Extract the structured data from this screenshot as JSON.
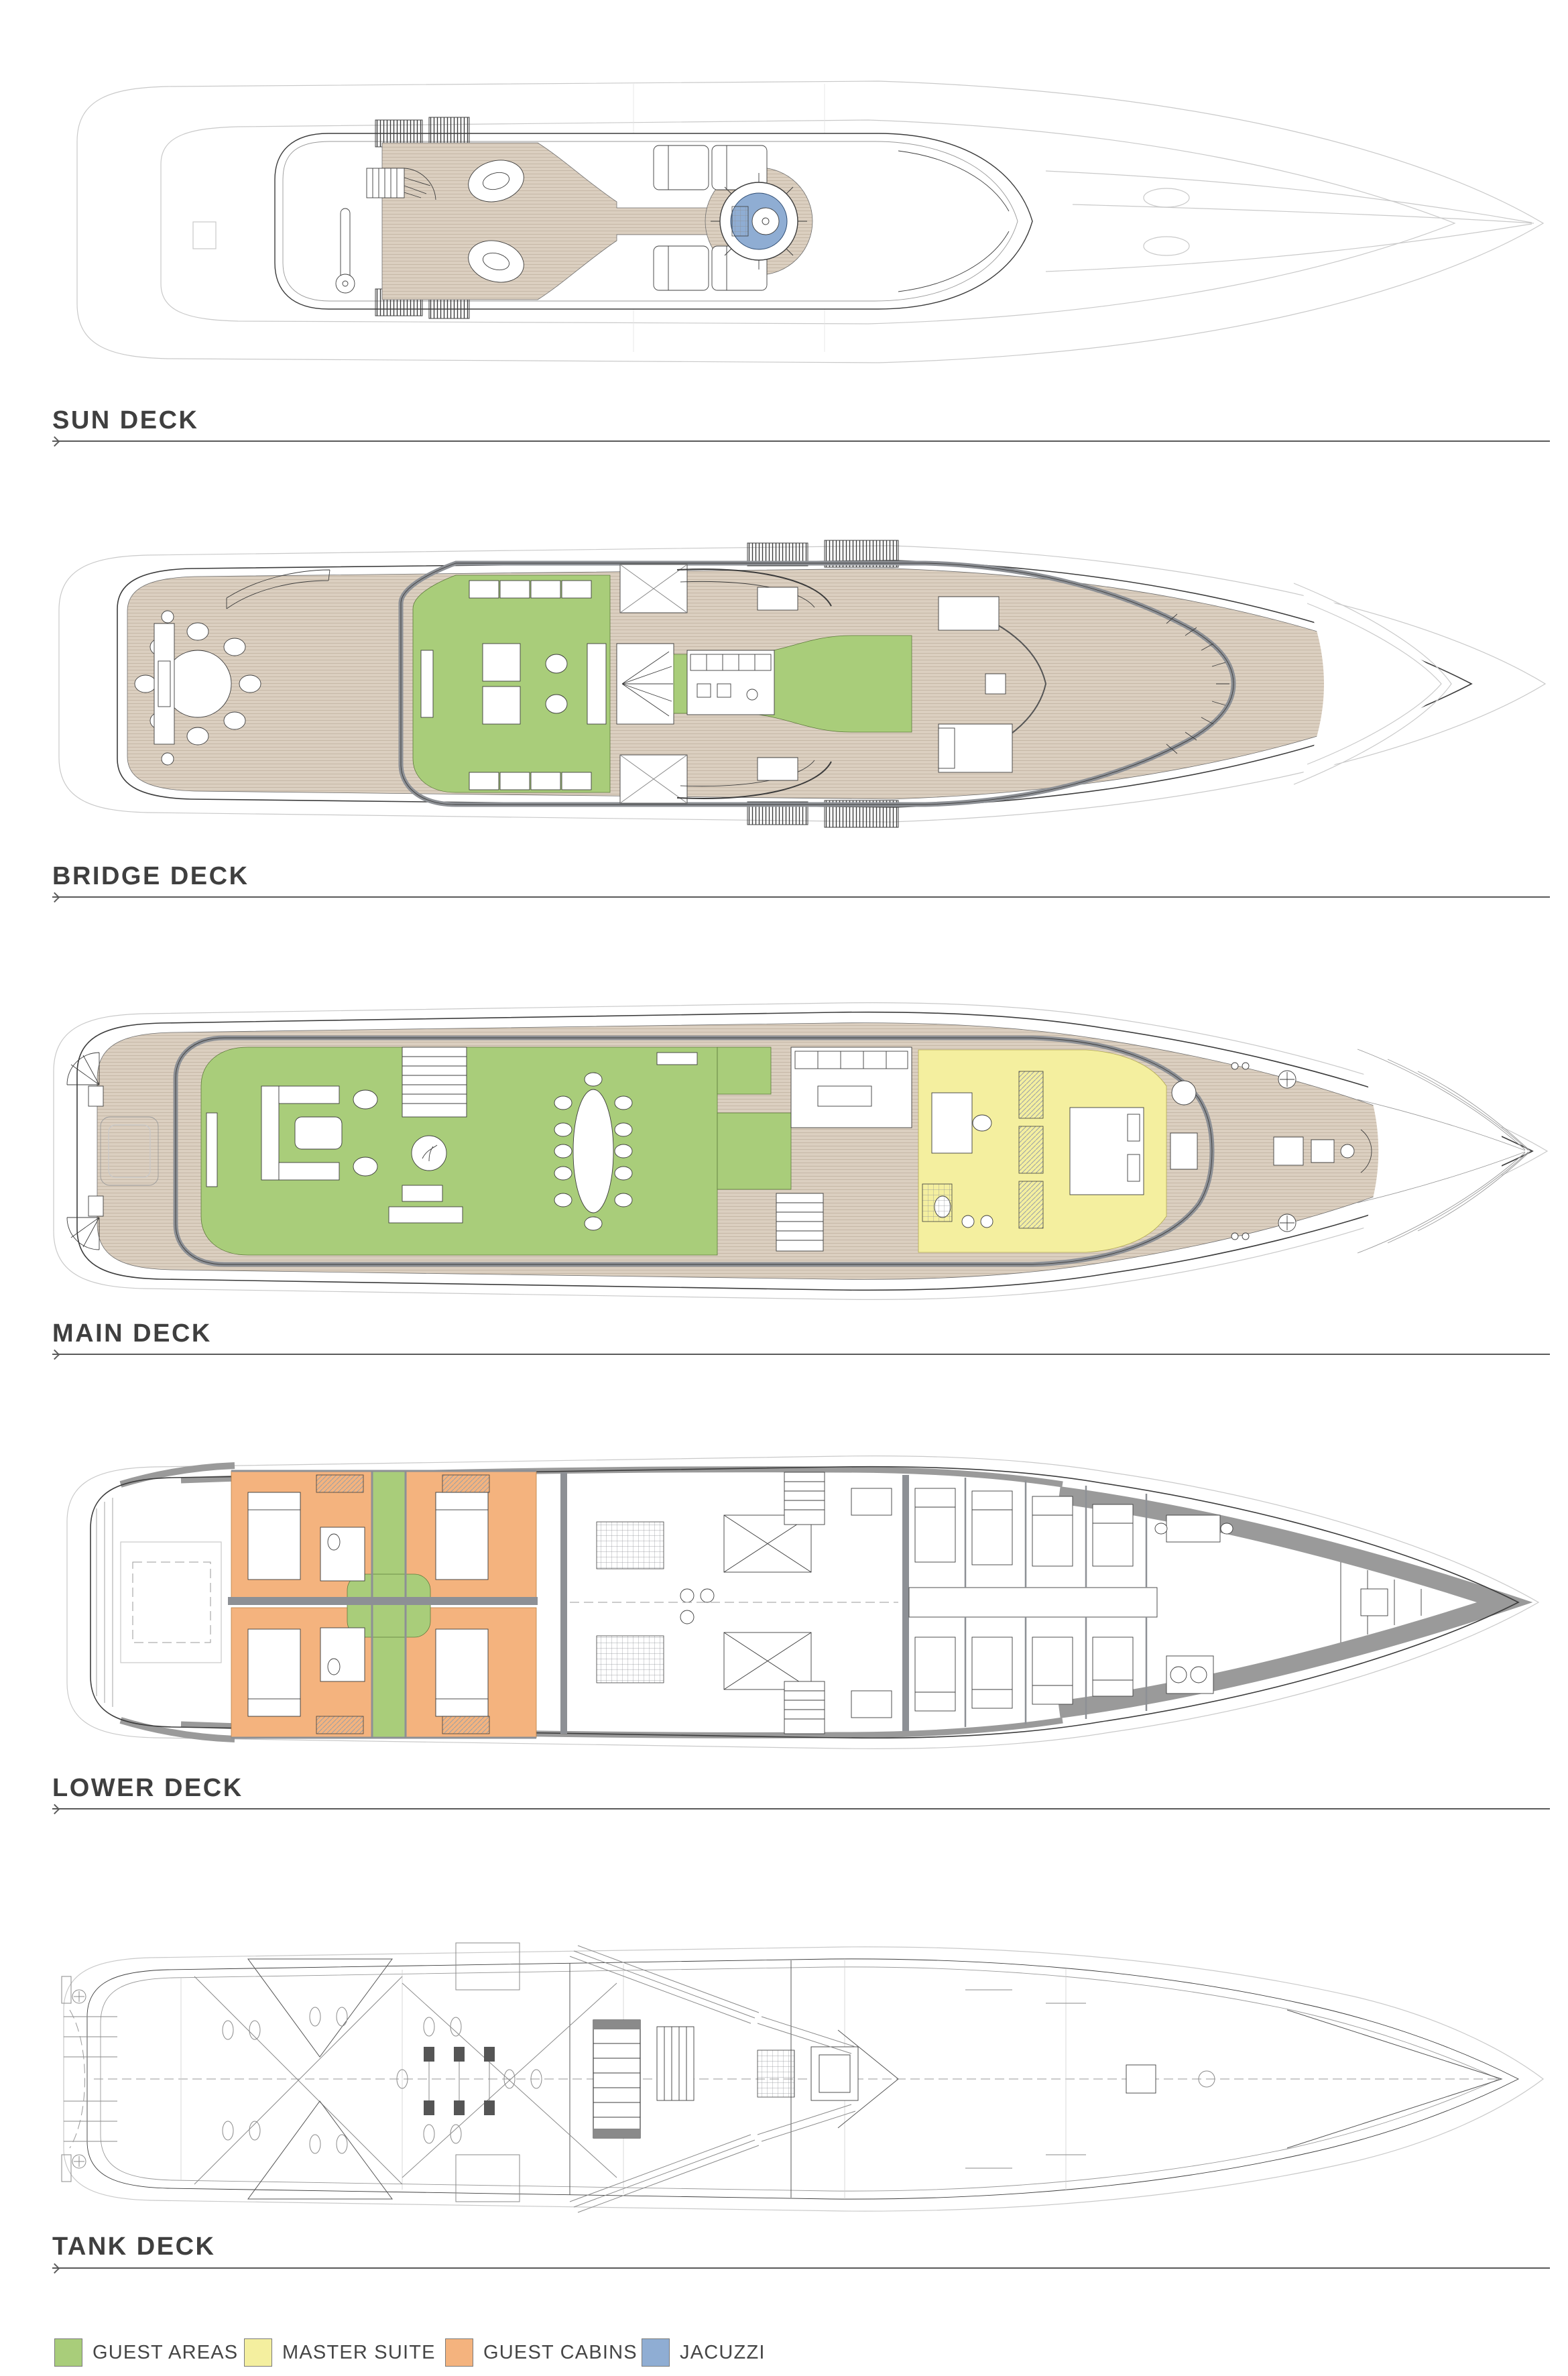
{
  "document": {
    "type": "yacht-deck-plans"
  },
  "decks": [
    {
      "id": "sun-deck",
      "name": "SUN DECK"
    },
    {
      "id": "bridge-deck",
      "name": "BRIDGE DECK"
    },
    {
      "id": "main-deck",
      "name": "MAIN DECK"
    },
    {
      "id": "lower-deck",
      "name": "LOWER DECK"
    },
    {
      "id": "tank-deck",
      "name": "TANK DECK"
    }
  ],
  "legend": [
    {
      "label": "GUEST AREAS",
      "color": "#a9cd7a"
    },
    {
      "label": "MASTER SUITE",
      "color": "#f4ef9f"
    },
    {
      "label": "GUEST CABINS",
      "color": "#f4b37e"
    },
    {
      "label": "JACUZZI",
      "color": "#8fadd3"
    }
  ],
  "palette": {
    "guest_areas": "#a9cd7a",
    "master_suite": "#f4ef9f",
    "guest_cabins": "#f4b37e",
    "jacuzzi": "#8fadd3",
    "teak_deck": "#dbcfc0",
    "interior_walls": "#8d9095",
    "hull_band": "#9a9a9a",
    "label_text": "#3f3f3f"
  }
}
